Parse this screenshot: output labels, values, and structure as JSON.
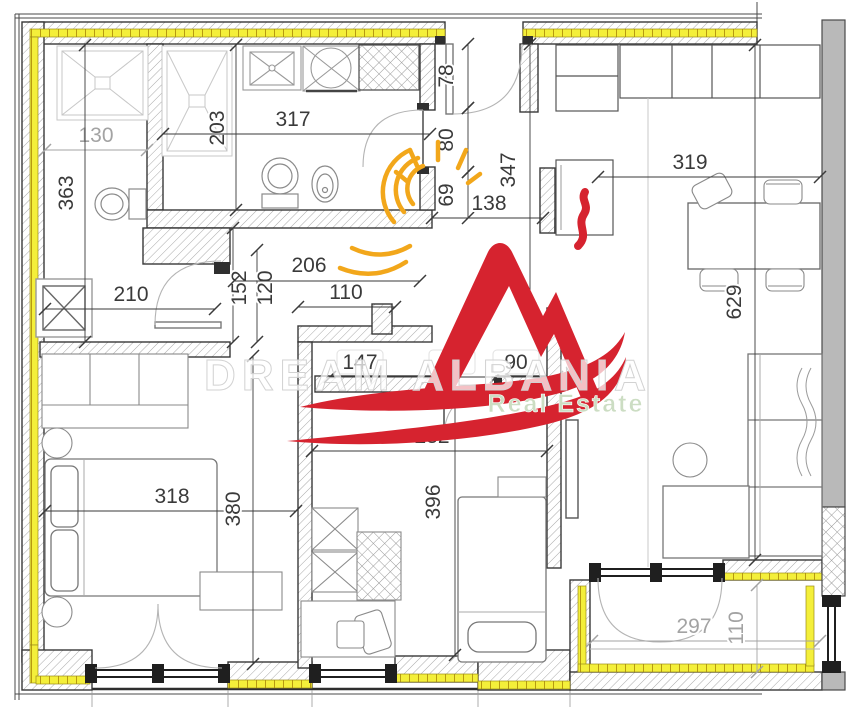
{
  "watermark": {
    "title": "DREAM ALBANIA",
    "subtitle": "Real Estate"
  },
  "dims": {
    "d130": "130",
    "d363": "363",
    "d203": "203",
    "d317": "317",
    "d210": "210",
    "d152": "152",
    "d120": "120",
    "d206": "206",
    "d110": "110",
    "d78": "78",
    "d80": "80",
    "d69": "69",
    "d138": "138",
    "d347": "347",
    "d319": "319",
    "d629": "629",
    "d147": "147",
    "d90a": "90",
    "d90b": "90",
    "d282": "282",
    "d396": "396",
    "d318": "318",
    "d380": "380",
    "d297": "297",
    "d110b": "110"
  },
  "colors": {
    "insulation_yellow": "#f4ef3a",
    "concrete_gray": "#b9b9b9",
    "logo_red": "#d6232f",
    "logo_orange": "#f2a71b",
    "watermark_green": "#ccddc3",
    "dim_dark": "#3a3a3a",
    "dim_light": "#a3a3a3"
  }
}
